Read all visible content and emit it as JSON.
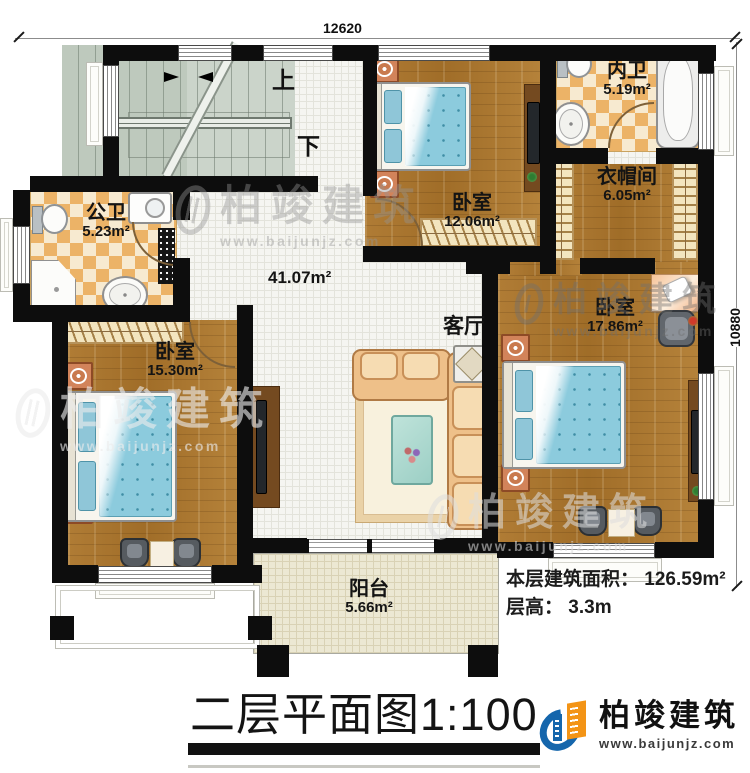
{
  "dimensions": {
    "top": "12620",
    "right": "10880"
  },
  "stairs": {
    "up": "上",
    "down": "下"
  },
  "rooms": [
    {
      "name": "公卫",
      "area": "5.23m²"
    },
    {
      "name": "卧室",
      "area": "12.06m²"
    },
    {
      "name": "内卫",
      "area": "5.19m²"
    },
    {
      "name": "衣帽间",
      "area": "6.05m²"
    },
    {
      "name": "卧室",
      "area": "15.30m²"
    },
    {
      "name": "卧室",
      "area": "17.86m²"
    },
    {
      "name": "阳台",
      "area": "5.66m²"
    }
  ],
  "living_room": {
    "name": "客厅"
  },
  "hall": {
    "area": "41.07m²"
  },
  "info": {
    "area_label": "本层建筑面积：",
    "area_value": "126.59m²",
    "height_label": "层高：",
    "height_value": "3.3m"
  },
  "title": {
    "name": "二层平面图",
    "scale": "1:100"
  },
  "watermark": {
    "text": "柏竣建筑",
    "url": "www.baijunjz.com"
  },
  "logo": {
    "text": "柏竣建筑",
    "url": "www.baijunjz.com"
  },
  "colors": {
    "wall": "#0d0d0d",
    "wood_floor": "#a97730",
    "bath_tile": "#ecb367",
    "bed": "#8ccbdd",
    "stairs": "#cbd4ca",
    "balcony": "#ece8d3",
    "logo_blue": "#1566ac",
    "logo_orange": "#f39416"
  }
}
